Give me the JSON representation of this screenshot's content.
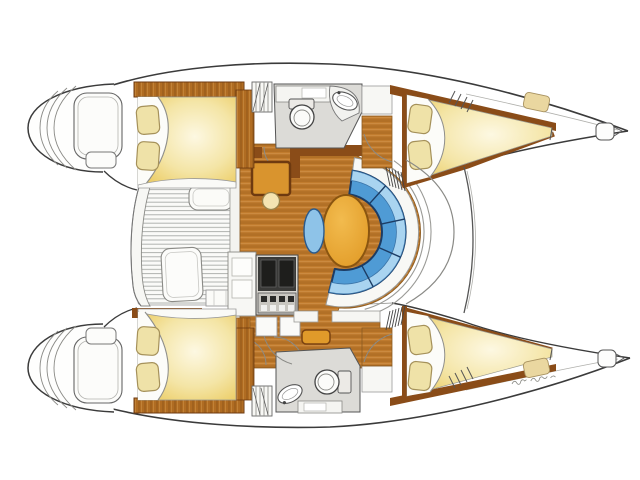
{
  "diagram": {
    "label": "Catamaran interior layout floor plan, top view, bows pointing right",
    "type": "boat-floorplan",
    "orientation": "bow-right"
  },
  "colors": {
    "background": "#ffffff",
    "outline": "#3b3b3b",
    "wood_floor": "#c17c2e",
    "wood_plank_line": "#a2641f",
    "wood_trim": "#8a4c18",
    "bed_light": "#fdf8e2",
    "bed_gold": "#e9c44e",
    "pillow": "#efe2a8",
    "sofa_seat": "#4f9bd5",
    "sofa_back": "#a9d4f0",
    "sofa_outline": "#1c3c64",
    "table": "#e19a26",
    "stool": "#8ec3e8",
    "bathroom_floor": "#dcdbd7",
    "fixture_white": "#fbfbf9",
    "deck_hatch": "#ead7a0",
    "appliance_dark": "#2e2e2c"
  },
  "regions": {
    "hulls": [
      "port-hull",
      "starboard-hull"
    ],
    "cabins": [
      "port-aft-cabin",
      "port-forward-cabin",
      "starboard-aft-cabin",
      "starboard-forward-cabin"
    ],
    "heads": [
      "port-head",
      "starboard-head"
    ],
    "saloon": [
      "dinette-table",
      "c-shaped-sofa",
      "stool",
      "nav-station",
      "galley-stove",
      "galley-counter"
    ],
    "exterior": [
      "cockpit",
      "port-transom-steps",
      "starboard-transom-steps",
      "forward-beam",
      "bow-lockers",
      "deck-hatches"
    ]
  },
  "signature": {
    "style": "handwritten",
    "legible": false,
    "position": "near-starboard-bow"
  }
}
